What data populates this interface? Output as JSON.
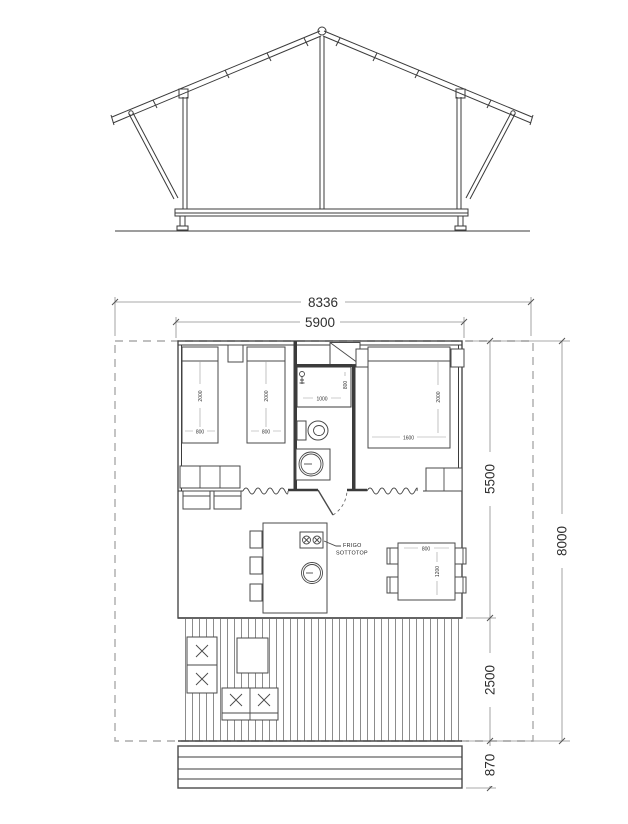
{
  "plan": {
    "dims": {
      "overall_width": "8336",
      "cabin_width": "5900",
      "cabin_depth": "5500",
      "deck_depth": "2500",
      "steps_depth": "870",
      "total_depth": "8000"
    },
    "labels": {
      "bed_length": "2000",
      "single_bed_width": "800",
      "double_bed_width": "1600",
      "shower_width": "1000",
      "shower_depth": "800",
      "table_width": "800",
      "table_length": "1200",
      "fridge_line1": "FRIGO",
      "fridge_line2": "SOTTOTOP"
    }
  }
}
